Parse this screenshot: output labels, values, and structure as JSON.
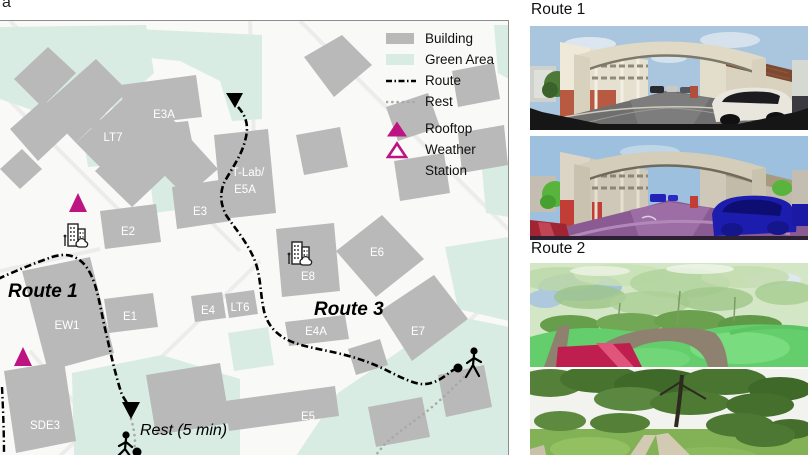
{
  "figure_label": "a",
  "map": {
    "legend": {
      "building": "Building",
      "green_area": "Green Area",
      "route": "Route",
      "rest": "Rest",
      "station_line1": "Rooftop",
      "station_line2": "Weather",
      "station_line3": "Station"
    },
    "annotations": {
      "route1": "Route 1",
      "route3": "Route 3",
      "rest_note": "Rest (5 min)"
    },
    "buildings": {
      "e3a": "E3A",
      "lt7": "LT7",
      "tlab1": "T-Lab/",
      "tlab2": "E5A",
      "e3": "E3",
      "e2": "E2",
      "e1": "E1",
      "e4": "E4",
      "lt6": "LT6",
      "e4a": "E4A",
      "e6": "E6",
      "e7": "E7",
      "e8": "E8",
      "e5": "E5",
      "ew1": "EW1",
      "sde3": "SDE3"
    },
    "colors": {
      "building": "#b9b9b9",
      "green_area": "#d8ece3",
      "route": "#000000",
      "rest_path": "#a8a8a8",
      "station": "#be1483"
    }
  },
  "panels": {
    "route1": {
      "title": "Route 1",
      "images": [
        "street-panorama-photo",
        "street-panorama-segmentation"
      ]
    },
    "route2": {
      "title": "Route 2",
      "images": [
        "park-panorama-segmentation",
        "park-panorama-photo"
      ]
    }
  }
}
